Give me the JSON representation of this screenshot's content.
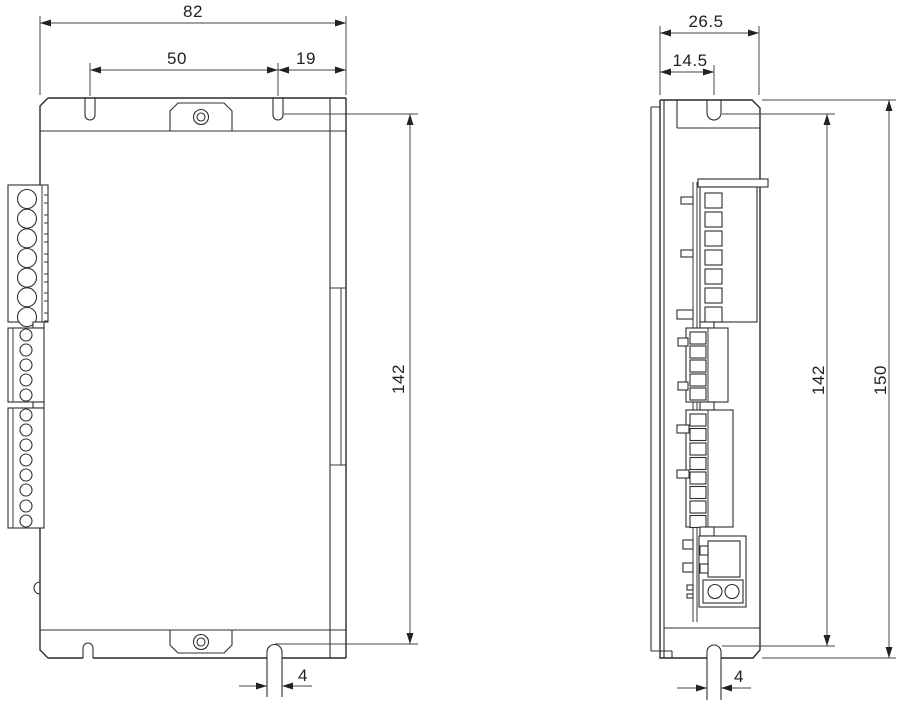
{
  "page": {
    "background": "#ffffff",
    "line_color": "#2a2a2a",
    "text_color": "#1f1f1f",
    "kind": "technical-dimension-drawing",
    "subject": "driver-module-outline-two-views"
  },
  "drawing": {
    "front_view": {
      "width_label": "82",
      "mount_span_label": "50",
      "mount_edge_label": "19",
      "mount_height_label": "142",
      "slot_width_label": "4"
    },
    "side_view": {
      "depth_label": "26.5",
      "slot_offset_label": "14.5",
      "mount_height_label": "142",
      "total_height_label": "150",
      "slot_width_label": "4"
    }
  }
}
